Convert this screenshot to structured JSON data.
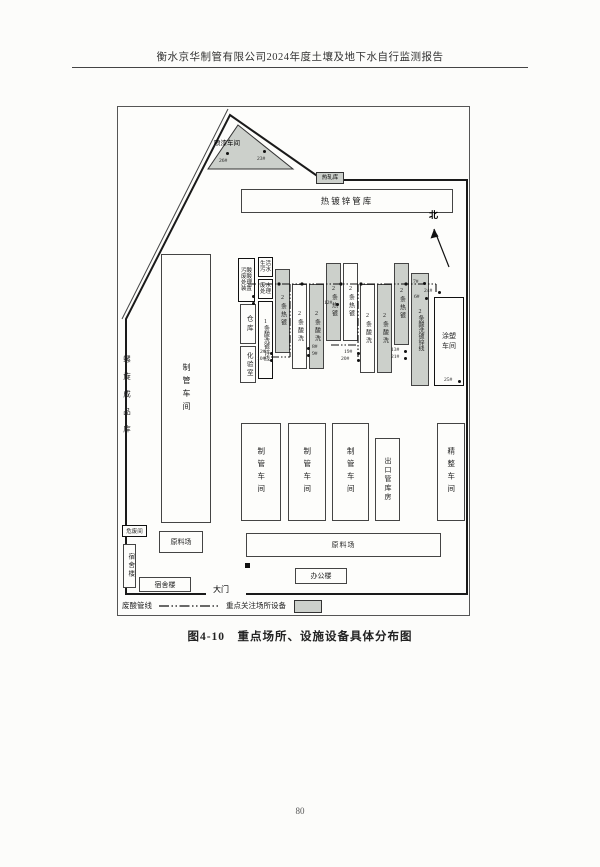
{
  "header": {
    "title": "衡水京华制管有限公司2024年度土壤及地下水自行监测报告"
  },
  "figure": {
    "caption": "图4-10　重点场所、设施设备具体分布图"
  },
  "page_number": "80",
  "compass": {
    "label": "北"
  },
  "legend": {
    "pipeline_label": "废酸管线",
    "key_label": "重点关注场所设备"
  },
  "site": {
    "paint_shop": "喷漆车间",
    "hot_rolling_store": "热轧库",
    "galvanized_pipe_store": "热镀锌管库",
    "spiral_product_store": "螺旋成品库",
    "main_pipe_shop": "制管车间",
    "acid_treatment": "污酸废酸处理装置",
    "domestic_sewage": "生活污水",
    "wastewater_treatment": "废水处理",
    "warehouse": "仓库",
    "lab": "化验室",
    "coating_shop": "涂塑车间",
    "pipe_shop": "制管车间",
    "export_pipe_store": "出口管库房",
    "finishing_shop": "精整车间",
    "raw_material_yard": "原料场",
    "office": "办公楼",
    "dormitory": "宿舍楼",
    "haz_waste_room": "危废间",
    "gate": "大门"
  },
  "strips": [
    {
      "label": "1条酸洗镀锌线"
    },
    {
      "label": "2条热镀"
    },
    {
      "label": "2条酸洗"
    },
    {
      "label": "2条酸洗"
    },
    {
      "label": "2条热镀"
    },
    {
      "label": "2条热镀"
    },
    {
      "label": "2条酸洗"
    },
    {
      "label": "2条酸洗"
    },
    {
      "label": "2条热镀"
    },
    {
      "label": "2条酸洗镀锌线"
    }
  ],
  "points": {
    "p26": "26#",
    "p23": "23#",
    "p12": "12#",
    "p2": "2#",
    "p10": "10#",
    "p8": "8#",
    "p9": "9#",
    "p19": "19#",
    "p20": "20#",
    "p13": "13#",
    "p21": "21#",
    "p24": "24#",
    "p25": "25#",
    "p7": "7#",
    "p6": "6#"
  }
}
